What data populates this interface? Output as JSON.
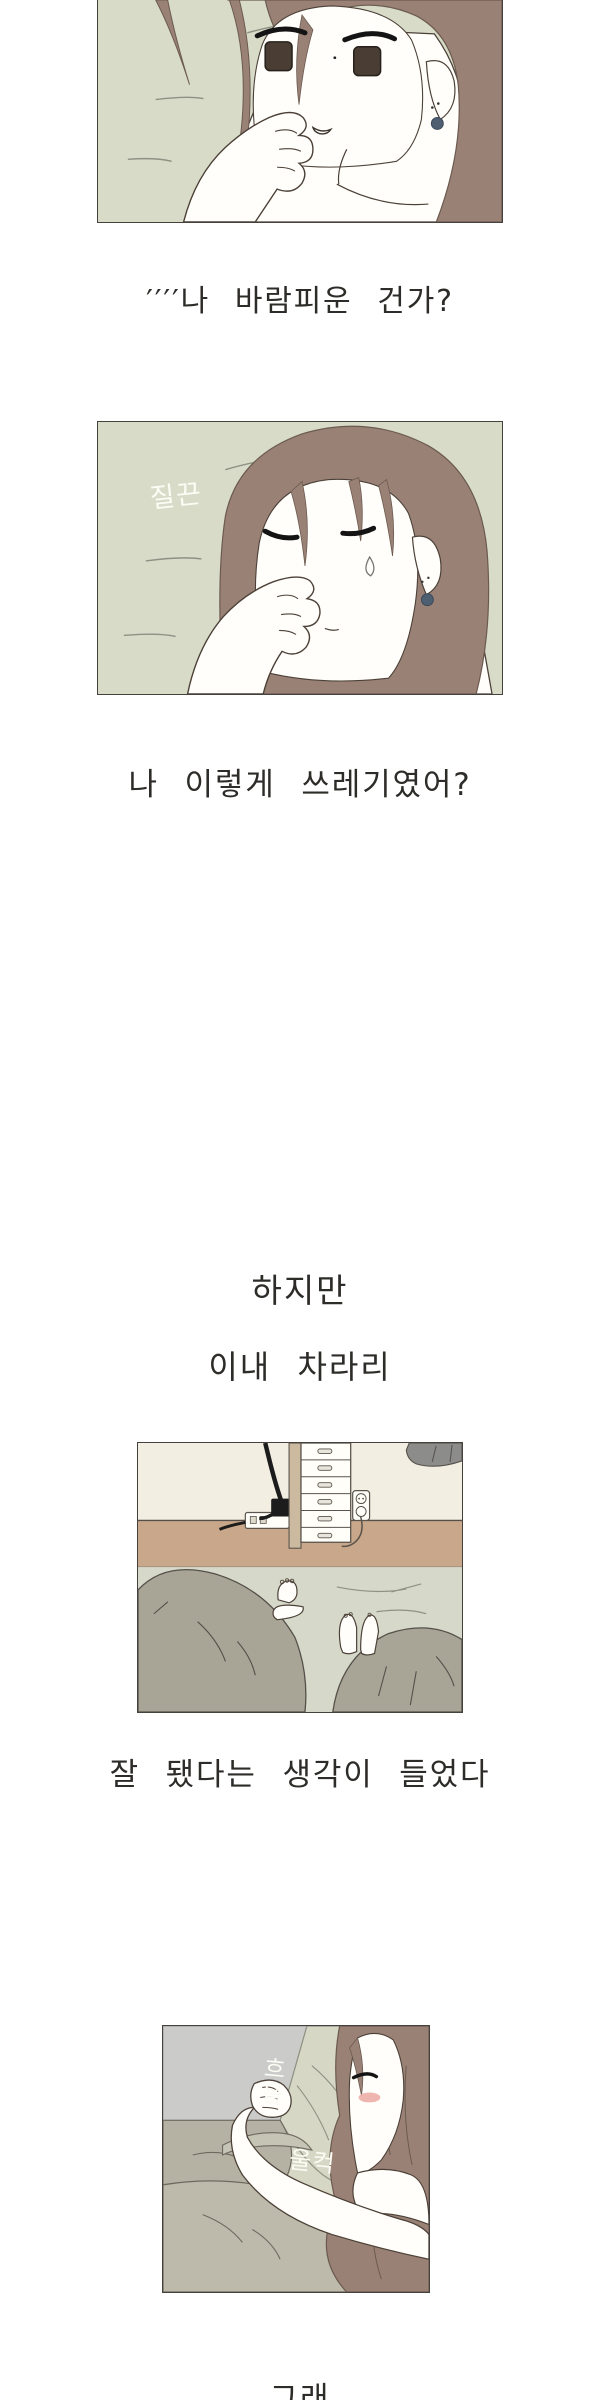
{
  "page": {
    "type": "webtoon vertical strip",
    "language": "ko",
    "background": "#ffffff"
  },
  "narration": {
    "line1": "′′′′나 바람피운 건가?",
    "line2": "나 이렇게 쓰레기였어?",
    "line3": "하지만",
    "line4": "이내 차라리",
    "line5": "잘 됐다는 생각이 들었다",
    "line6": "그래"
  },
  "sfx": {
    "panel2_squeeze": "질끈",
    "panel4_sigh": "흐음",
    "panel4_surge": "울컥"
  },
  "panels": [
    {
      "id": "panel-1"
    },
    {
      "id": "panel-2"
    },
    {
      "id": "panel-3"
    },
    {
      "id": "panel-4"
    }
  ],
  "colors": {
    "page_bg": "#ffffff",
    "panel_border": "#45413c",
    "pillow_green": "#d8dbc8",
    "hair_brown": "#9a8175",
    "hair_outline": "#6b5a50",
    "skin_white": "#fffefa",
    "ink_outline": "#4c4138",
    "eye_iris": "#4a3d33",
    "earring_blue": "#4e5f72",
    "wall_cream": "#f3eee2",
    "floor_tan": "#c9a78a",
    "bedding_green": "#d6d9c9",
    "blanket_gray": "#a8a496",
    "cloth_gray": "#8c8c8a",
    "drawer_wood": "#cbb9a0",
    "wall_gray": "#cbcbca",
    "pillow_sage": "#d6d7c5",
    "blanket_sage": "#bdbaab",
    "blush_pink": "#eba9a0",
    "narration_ink": "#2e2c29",
    "sfx_white": "#fbfcf4"
  }
}
